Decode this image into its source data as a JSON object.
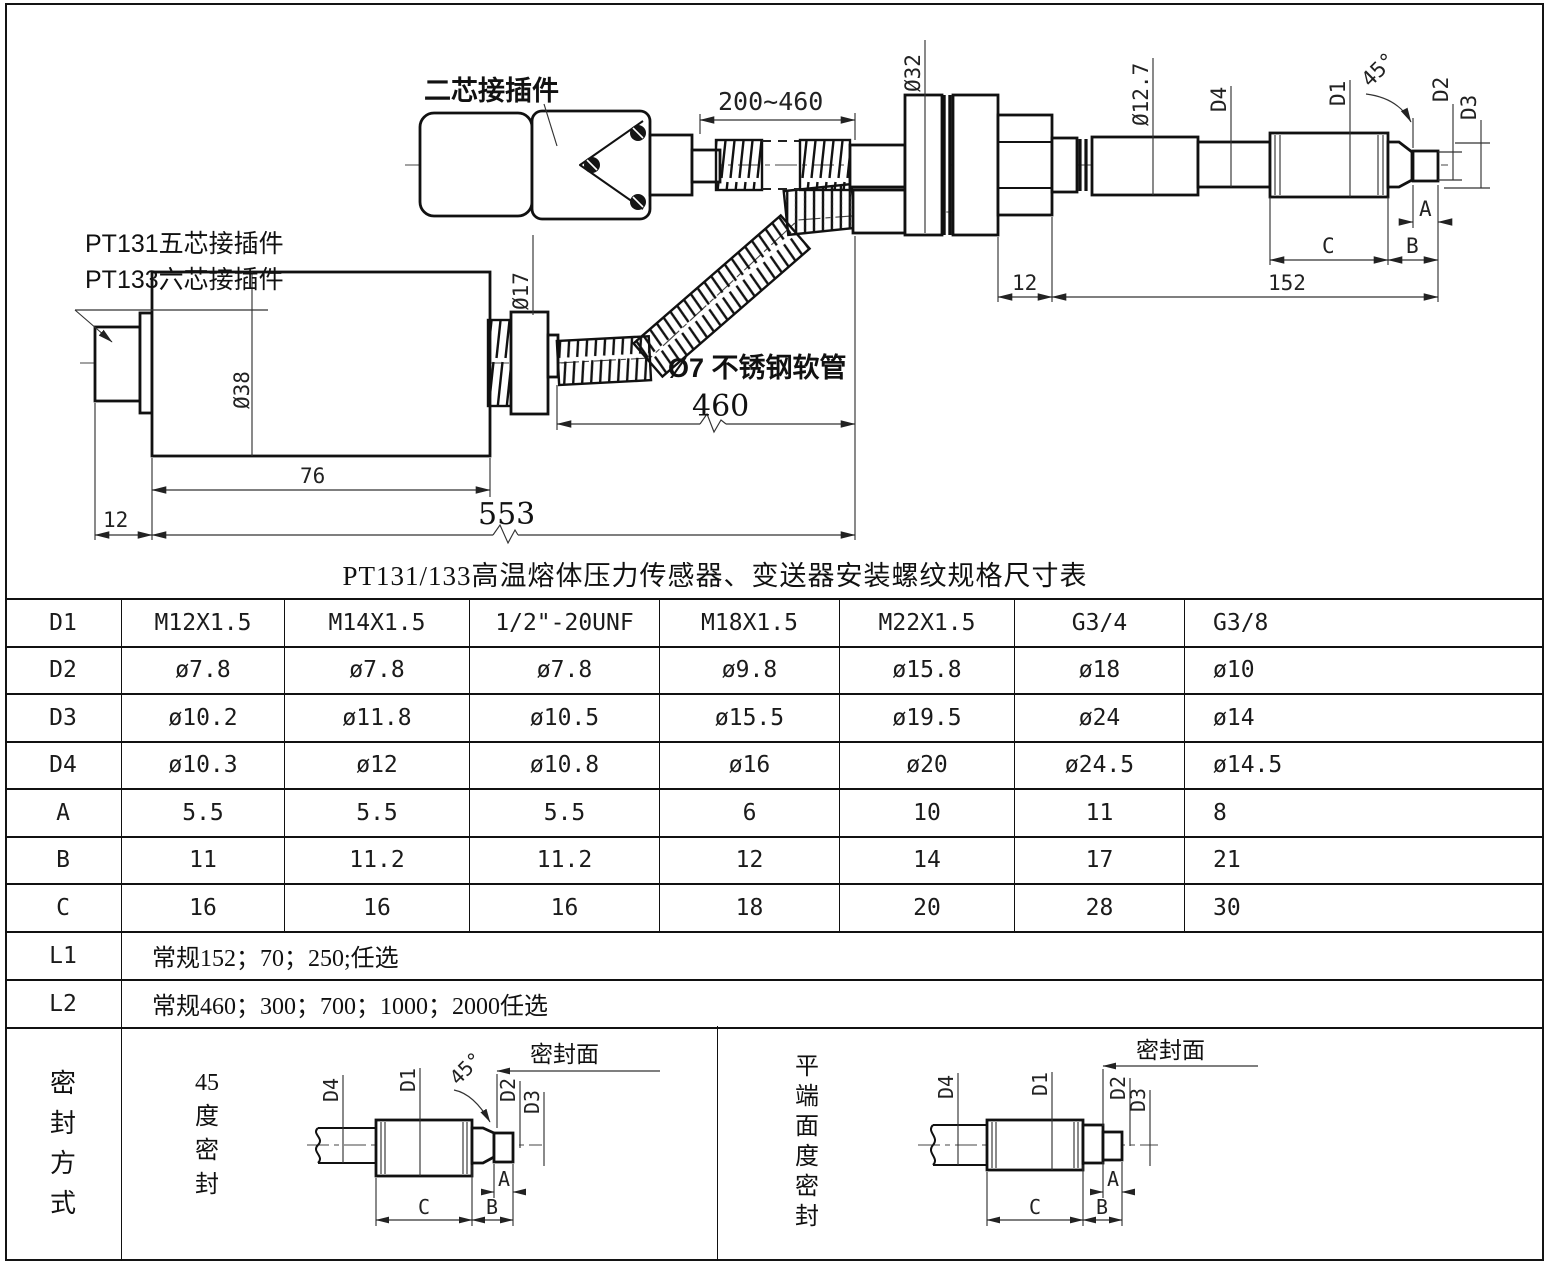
{
  "page": {
    "bg": "#ffffff",
    "line_color": "#111111"
  },
  "dims": {
    "d1": "D1",
    "d2": "D2",
    "d3": "D3",
    "d4": "D4",
    "a": "A",
    "b": "B",
    "c": "C",
    "deg45": "45°",
    "face": "密封面"
  },
  "drawing": {
    "connector_two_core": "二芯接插件",
    "connector_pt131": "PT131五芯接插件",
    "connector_pt133": "PT133六芯接插件",
    "hose_label": "Ø7 不锈钢软管",
    "len_range": "200~460",
    "phi32": "Ø32",
    "phi17": "Ø17",
    "phi38": "Ø38",
    "phi12_7": "Ø12.7",
    "len_152": "152",
    "len_12_flange": "12",
    "len_553": "553",
    "len_460": "460",
    "len_76": "76",
    "len_12_left": "12"
  },
  "table": {
    "title": "PT131/133高温熔体压力传感器、变送器安装螺纹规格尺寸表",
    "rows": [
      {
        "label": "D1",
        "values": [
          "M12X1.5",
          "M14X1.5",
          "1/2\"-20UNF",
          "M18X1.5",
          "M22X1.5",
          "G3/4",
          "G3/8"
        ]
      },
      {
        "label": "D2",
        "values": [
          "ø7.8",
          "ø7.8",
          "ø7.8",
          "ø9.8",
          "ø15.8",
          "ø18",
          "ø10"
        ]
      },
      {
        "label": "D3",
        "values": [
          "ø10.2",
          "ø11.8",
          "ø10.5",
          "ø15.5",
          "ø19.5",
          "ø24",
          "ø14"
        ]
      },
      {
        "label": "D4",
        "values": [
          "ø10.3",
          "ø12",
          "ø10.8",
          "ø16",
          "ø20",
          "ø24.5",
          "ø14.5"
        ]
      },
      {
        "label": "A",
        "values": [
          "5.5",
          "5.5",
          "5.5",
          "6",
          "10",
          "11",
          "8"
        ]
      },
      {
        "label": "B",
        "values": [
          "11",
          "11.2",
          "11.2",
          "12",
          "14",
          "17",
          "21"
        ]
      },
      {
        "label": "C",
        "values": [
          "16",
          "16",
          "16",
          "18",
          "20",
          "28",
          "30"
        ]
      }
    ],
    "l1_label": "L1",
    "l1_value": "常规152；70；250;任选",
    "l2_label": "L2",
    "l2_value": "常规460；300；700；1000；2000任选"
  },
  "seal": {
    "header": "密封方式",
    "left_title": "45度密封",
    "right_title": "平端面度密封"
  }
}
